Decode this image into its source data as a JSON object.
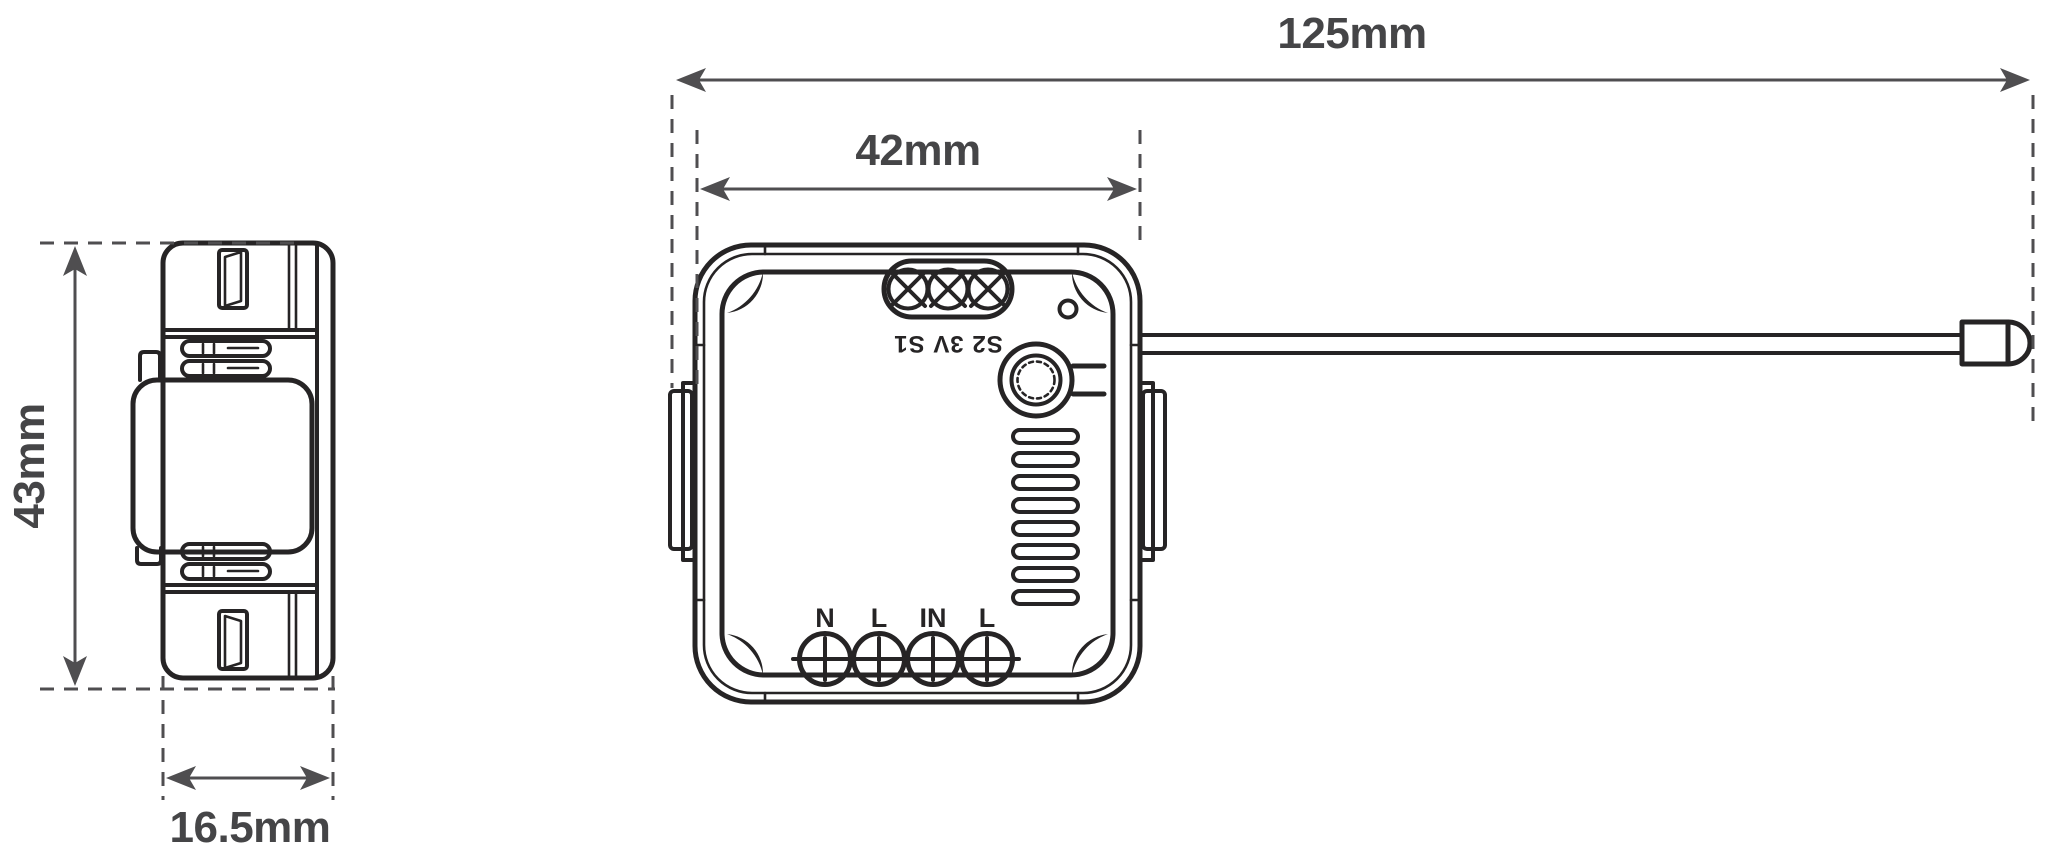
{
  "colors": {
    "background": "#ffffff",
    "device_line": "#262425",
    "dimension_line": "#4f4e50",
    "label_text": "#454547"
  },
  "dimensions": {
    "total_width": {
      "label": "125mm"
    },
    "body_width": {
      "label": "42mm"
    },
    "body_height": {
      "label": "43mm"
    },
    "body_depth": {
      "label": "16.5mm"
    }
  },
  "device": {
    "front": {
      "top_terminals": {
        "label": "S2 3V S1"
      },
      "bottom_terminals": {
        "labels": [
          "N",
          "L",
          "IN",
          "L"
        ]
      }
    }
  }
}
